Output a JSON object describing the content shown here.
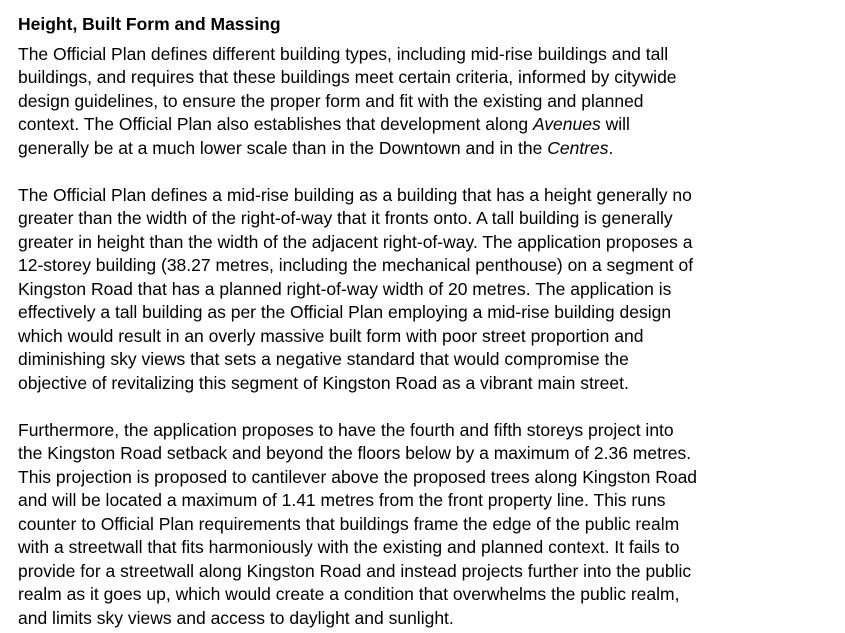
{
  "document": {
    "heading": "Height, Built Form and Massing",
    "text_color": "#000000",
    "background_color": "#ffffff",
    "paragraphs": [
      {
        "lines": [
          "The Official Plan defines different building types, including mid-rise buildings and tall",
          "buildings, and requires that these buildings meet certain criteria, informed by citywide",
          "design guidelines, to ensure the proper form and fit with the existing and planned",
          [
            {
              "text": "context. The Official Plan also establishes that development along "
            },
            {
              "text": "Avenues",
              "italic": true
            },
            {
              "text": " will"
            }
          ],
          [
            {
              "text": "generally be at a much lower scale than in the Downtown and in the "
            },
            {
              "text": "Centres",
              "italic": true
            },
            {
              "text": "."
            }
          ]
        ]
      },
      {
        "lines": [
          "The Official Plan defines a mid-rise building as a building that has a height generally no",
          "greater than the width of the right-of-way that it fronts onto. A tall building is generally",
          "greater in height than the width of the adjacent right-of-way. The application proposes a",
          "12-storey building (38.27 metres, including the mechanical penthouse) on a segment of",
          "Kingston Road that has a planned right-of-way width of 20 metres. The application is",
          "effectively a tall building as per the Official Plan employing a mid-rise building design",
          "which would result in an overly massive built form with poor street proportion and",
          "diminishing sky views that sets a negative standard that would compromise the",
          "objective of revitalizing this segment of Kingston Road as a vibrant main street."
        ]
      },
      {
        "lines": [
          "Furthermore, the application proposes to have the fourth and fifth storeys project into",
          "the Kingston Road setback and beyond the floors below by a maximum of 2.36 metres.",
          "This projection is proposed to cantilever above the proposed trees along Kingston Road",
          "and will be located a maximum of 1.41 metres from the front property line. This runs",
          "counter to Official Plan requirements that buildings frame the edge of the public realm",
          "with a streetwall that fits harmoniously with the existing and planned context. It fails to",
          "provide for a streetwall along Kingston Road and instead projects further into the public",
          "realm as it goes up, which would create a condition that overwhelms the public realm,",
          "and limits sky views and access to daylight and sunlight."
        ]
      }
    ]
  }
}
